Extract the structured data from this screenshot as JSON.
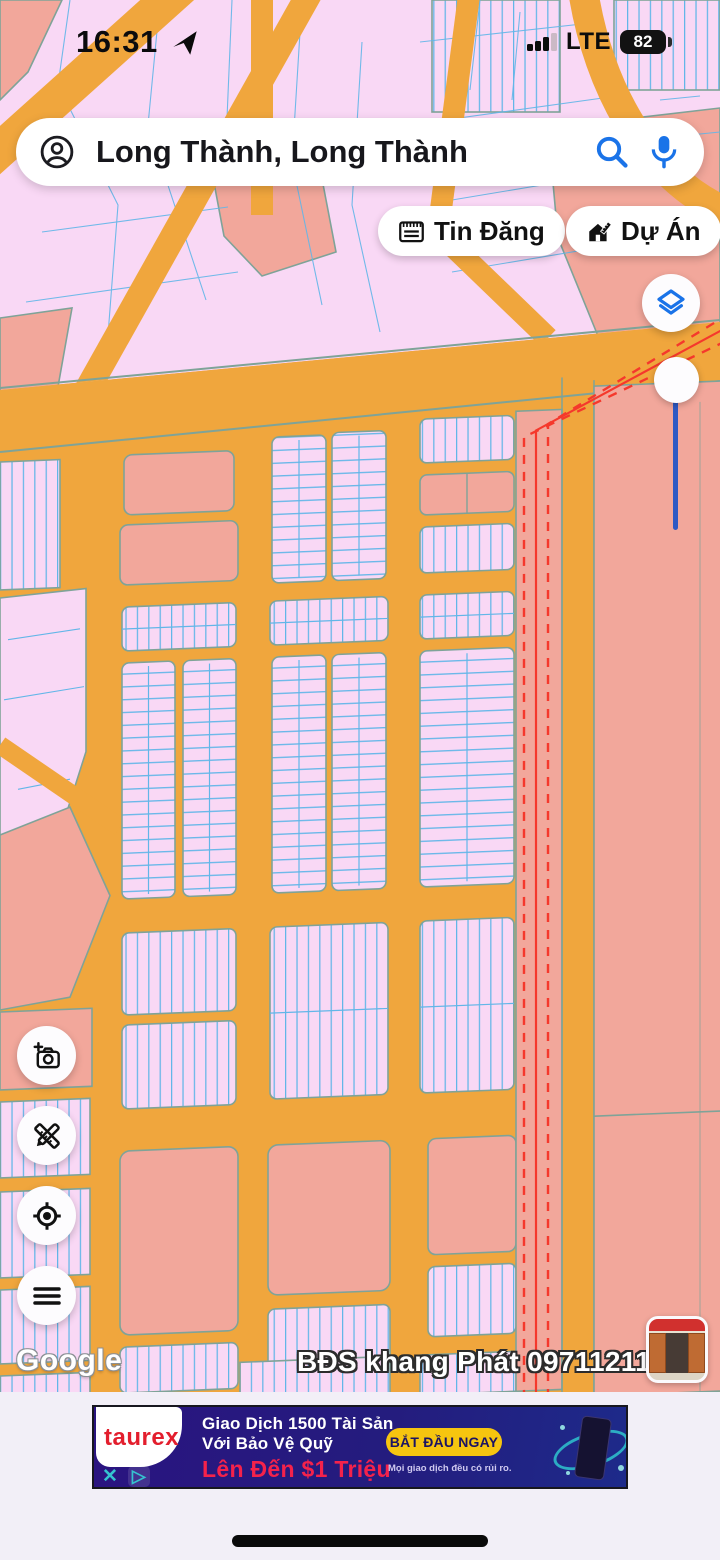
{
  "status_bar": {
    "time": "16:31",
    "network": "LTE",
    "battery": "82"
  },
  "search": {
    "query": "Long Thành, Long Thành"
  },
  "chips": {
    "posts": "Tin Đăng",
    "projects": "Dự Án"
  },
  "watermark": {
    "google": "Google",
    "agent": "BĐS khang Phát 0971121117"
  },
  "ad": {
    "brand": "taurex",
    "line1": "Giao Dịch 1500 Tài Sản",
    "line2": "Với Bảo Vệ Quỹ",
    "highlight": "Lên Đến $1 Triệu",
    "cta": "BẮT ĐẦU NGAY",
    "disclaimer": "Mọi giao dịch đều có rủi ro.",
    "close": "✕",
    "adchoices": "▷"
  },
  "icons": {
    "account": "person-circle-icon",
    "search": "magnifier-icon",
    "voice": "mic-icon",
    "posts_chip": "newspaper-icon",
    "projects_chip": "house-ruler-icon",
    "layers": "layers-icon",
    "add_photo": "camera-plus-icon",
    "draw": "pencil-ruler-icon",
    "my_location": "crosshair-icon",
    "menu": "hamburger-icon",
    "status_location": "nav-arrow-icon"
  },
  "colors": {
    "road-orange": "#f0a63d",
    "parcel-pink": "#f9d8f5",
    "parcel-salmon": "#f2a79b",
    "line-blue": "#62b6e8",
    "line-teal": "#7fa398",
    "line-red": "#f5382c",
    "accent-blue": "#1a73e8",
    "slider-blue": "#2e59c4",
    "bottom-bg": "#f2eff7",
    "ad-red": "#f4224b",
    "ad-yellow": "#f6c50f",
    "taurex-red": "#e31e2d"
  }
}
